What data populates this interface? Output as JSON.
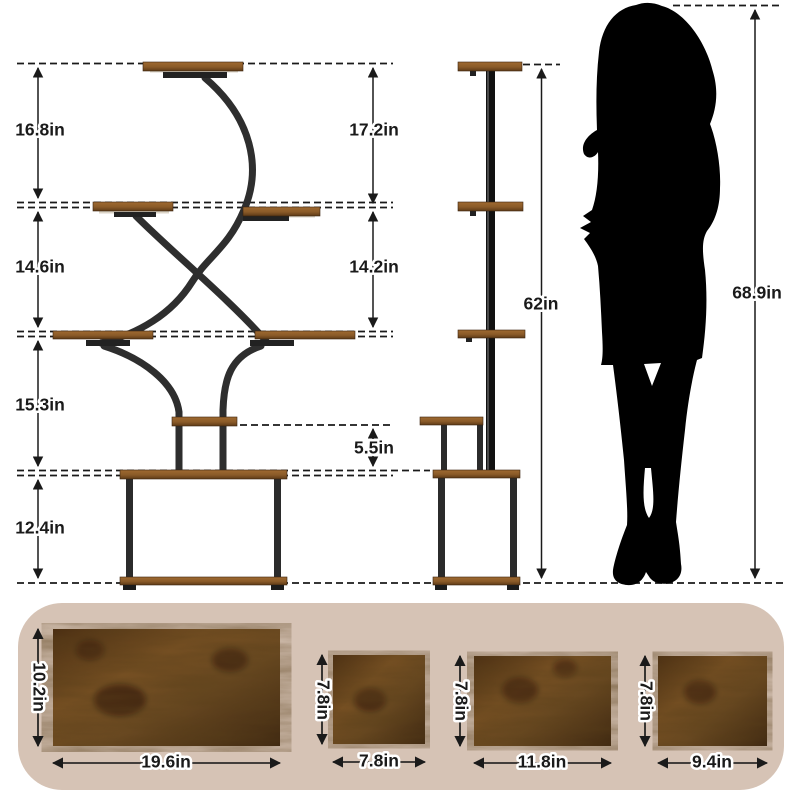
{
  "dims": {
    "front_left": [
      "16.8in",
      "14.6in",
      "15.3in",
      "12.4in"
    ],
    "front_right": [
      "17.2in",
      "14.2in",
      "5.5in"
    ],
    "side_total_height": "62in",
    "person_height": "68.9in"
  },
  "boards": [
    {
      "depth": "10.2in",
      "width": "19.6in"
    },
    {
      "depth": "7.8in",
      "width": "7.8in"
    },
    {
      "depth": "7.8in",
      "width": "11.8in"
    },
    {
      "depth": "7.8in",
      "width": "9.4in"
    }
  ],
  "colors": {
    "metal": "#2e2e2e",
    "wood": "#8a5a28",
    "wood_dark": "#4a2d12",
    "panel_bg": "#d6c3b5",
    "ink": "#1a1a1a",
    "silhouette": "#000000",
    "background": "#ffffff"
  }
}
